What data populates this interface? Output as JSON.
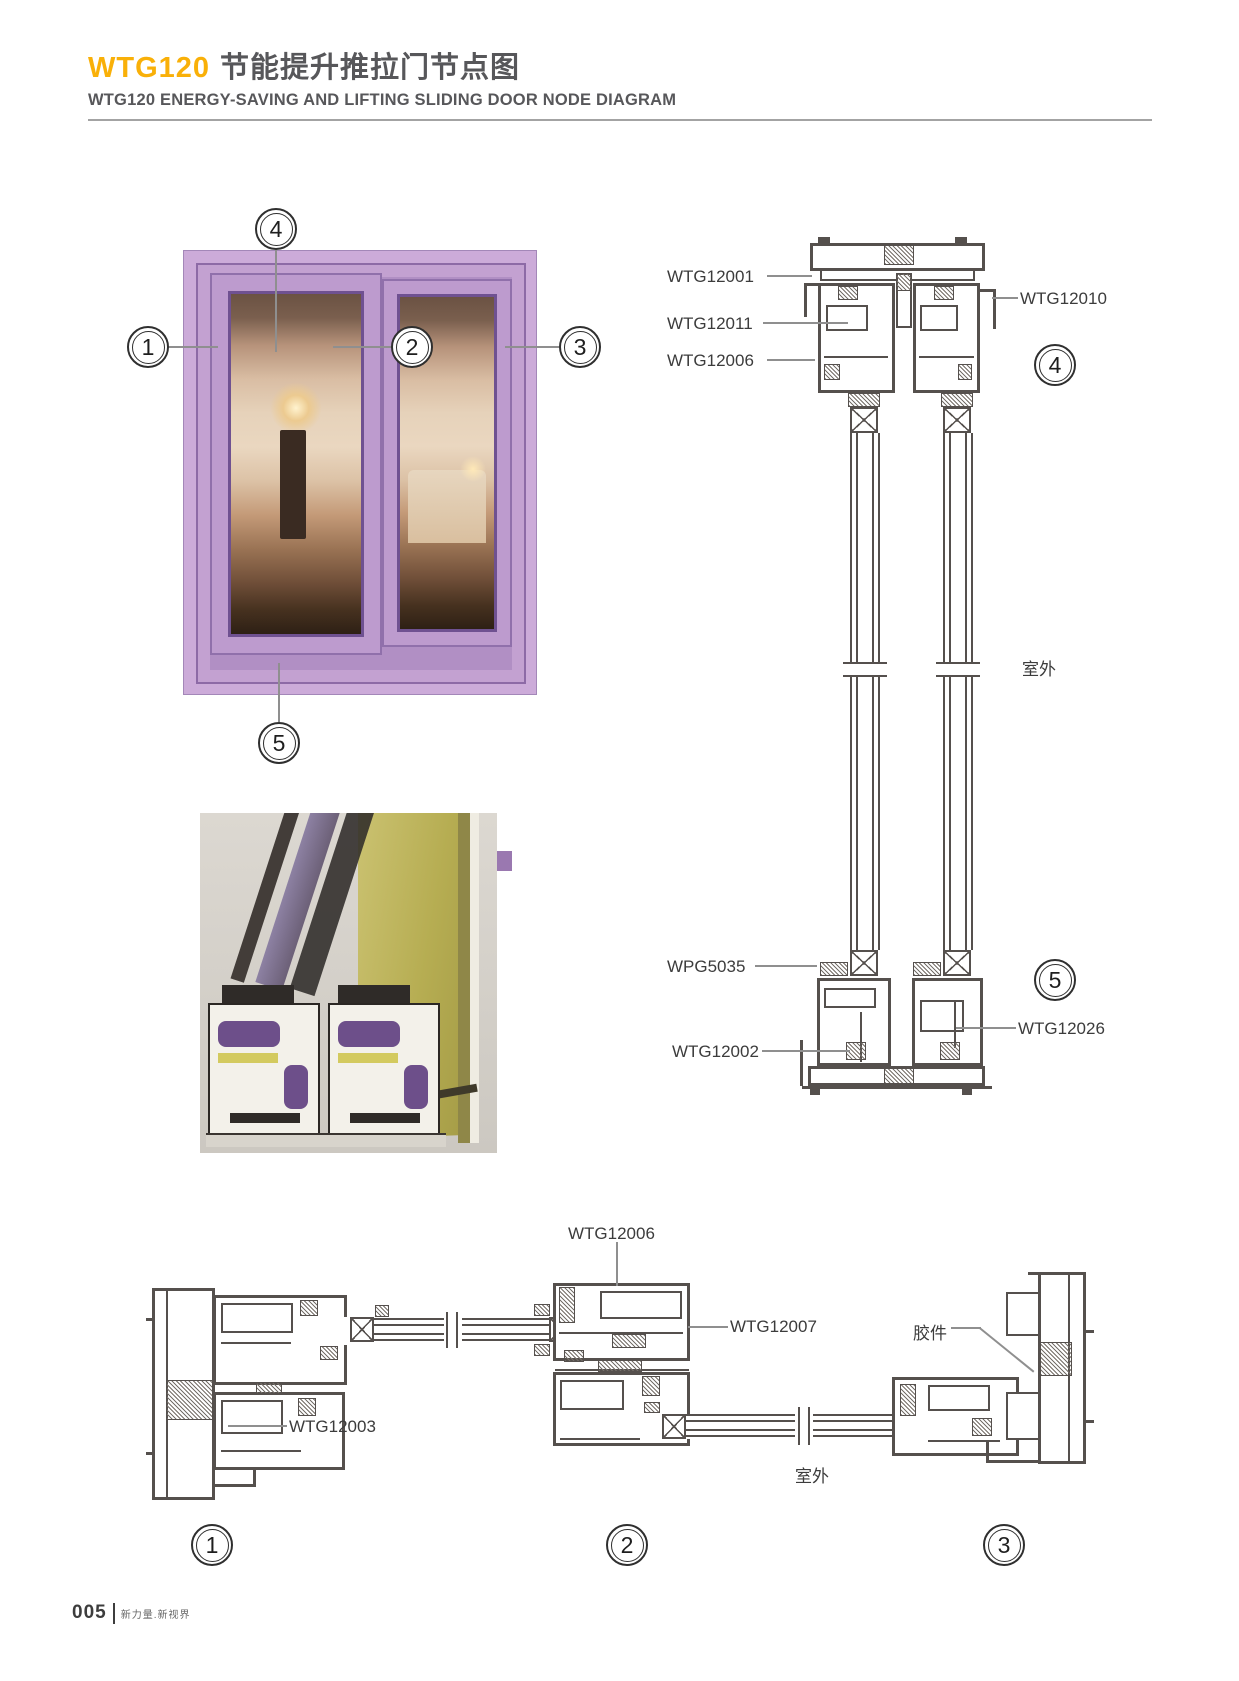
{
  "header": {
    "model": "WTG120",
    "title_cn": "节能提升推拉门节点图",
    "subtitle": "WTG120 ENERGY-SAVING AND LIFTING SLIDING DOOR NODE DIAGRAM"
  },
  "photo_callouts": {
    "c1": "1",
    "c2": "2",
    "c3": "3",
    "c4": "4",
    "c5": "5"
  },
  "vertical_section": {
    "wtg12001": "WTG12001",
    "wtg12011": "WTG12011",
    "wtg12006": "WTG12006",
    "wtg12010": "WTG12010",
    "wpg5035": "WPG5035",
    "wtg12002": "WTG12002",
    "wtg12026": "WTG12026",
    "outdoor": "室外",
    "callout_top": "4",
    "callout_bottom": "5"
  },
  "horizontal_section": {
    "wtg12006": "WTG12006",
    "wtg12007": "WTG12007",
    "wtg12003": "WTG12003",
    "glue": "胶件",
    "outdoor": "室外",
    "callout_1": "1",
    "callout_2": "2",
    "callout_3": "3"
  },
  "footer": {
    "page": "005",
    "slogan": "新力量.新视界"
  },
  "colors": {
    "accent_orange": "#F9B008",
    "title_gray": "#57575A",
    "frame_purple": "#CCABD9",
    "profile_line": "#55504D",
    "leader_gray": "#8F8F8F"
  }
}
